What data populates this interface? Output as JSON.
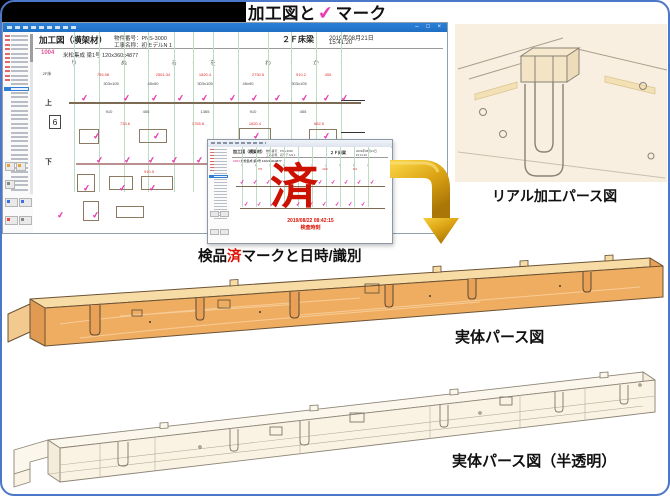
{
  "page": {
    "title": {
      "prefix": "加工図と",
      "check": "✔",
      "suffix": "マーク"
    }
  },
  "colors": {
    "check_magenta": "#e83cb0",
    "done_red": "#cc1100",
    "titlebar_blue": "#2a80d8",
    "arrow_gold": "#d29a00",
    "wood": "#efad62",
    "grid_green": "#bcdcc4",
    "frame_blue": "#4a77c8"
  },
  "main_window": {
    "titlebar_buttons": [
      "minimize",
      "maximize",
      "close"
    ],
    "header": {
      "doc_title": "加工図（横架材）",
      "property_label": "物件番号：PNS-3000",
      "project_label": "工事名称：初モデルN 1",
      "floor": "２Ｆ床梁",
      "date": "2019年08月21日",
      "time": "15:41:20",
      "part_no": "1004",
      "part_desc": "米松集成 梁1号 120x360x4877"
    },
    "sidebar": {
      "row_count": 36,
      "red_count": 11,
      "selected_index": 12
    },
    "drawing": {
      "left_label": "2F床",
      "row_label_top": "上",
      "row_label_bottom": "下",
      "sheet_no": "6",
      "grid_labels": [
        {
          "t": "り",
          "x": 41
        },
        {
          "t": "ぬ",
          "x": 91
        },
        {
          "t": "る",
          "x": 141
        },
        {
          "t": "を",
          "x": 180
        },
        {
          "t": "わ",
          "x": 235
        },
        {
          "t": "か",
          "x": 283
        }
      ],
      "grid_minor_xs": [
        66,
        115,
        160,
        205,
        258,
        308
      ],
      "grid_line_xs": [
        41,
        66,
        91,
        115,
        141,
        160,
        180,
        205,
        235,
        258,
        283,
        308
      ],
      "check_mark": "✔",
      "check_groups": [
        {
          "y": 62,
          "xs": [
            48,
            90,
            118,
            144,
            168,
            196,
            218,
            241,
            268,
            290,
            308
          ]
        },
        {
          "y": 100,
          "xs": [
            60,
            120,
            220,
            290
          ]
        },
        {
          "y": 124,
          "xs": [
            63,
            91,
            115,
            138,
            163,
            190,
            220,
            250,
            280
          ]
        },
        {
          "y": 152,
          "xs": [
            50,
            86,
            116,
            218,
            238
          ]
        },
        {
          "y": 179,
          "xs": [
            24,
            59
          ]
        }
      ],
      "dims": [
        {
          "x": 70,
          "y": 40,
          "t": "755.98",
          "c": "red"
        },
        {
          "x": 130,
          "y": 40,
          "t": "2561.34",
          "c": "red"
        },
        {
          "x": 172,
          "y": 40,
          "t": "1820.4",
          "c": "red"
        },
        {
          "x": 225,
          "y": 40,
          "t": "2730.5",
          "c": "red"
        },
        {
          "x": 268,
          "y": 40,
          "t": "910.2",
          "c": "red"
        },
        {
          "x": 295,
          "y": 40,
          "t": "455",
          "c": "red"
        },
        {
          "x": 78,
          "y": 49,
          "t": "303x105",
          "c": "blk"
        },
        {
          "x": 120,
          "y": 49,
          "t": "45x90",
          "c": "blk"
        },
        {
          "x": 172,
          "y": 49,
          "t": "303x105",
          "c": "blk"
        },
        {
          "x": 215,
          "y": 49,
          "t": "45x90",
          "c": "blk"
        },
        {
          "x": 266,
          "y": 49,
          "t": "303x105",
          "c": "blk"
        },
        {
          "x": 76,
          "y": 77,
          "t": "910",
          "c": "blk"
        },
        {
          "x": 113,
          "y": 77,
          "t": "455",
          "c": "blk"
        },
        {
          "x": 172,
          "y": 77,
          "t": "1365",
          "c": "blk"
        },
        {
          "x": 220,
          "y": 77,
          "t": "910",
          "c": "blk"
        },
        {
          "x": 270,
          "y": 77,
          "t": "455",
          "c": "blk"
        },
        {
          "x": 92,
          "y": 89,
          "t": "733.6",
          "c": "red"
        },
        {
          "x": 165,
          "y": 89,
          "t": "1765.8",
          "c": "red"
        },
        {
          "x": 222,
          "y": 89,
          "t": "1820.4",
          "c": "red"
        },
        {
          "x": 286,
          "y": 89,
          "t": "682.5",
          "c": "red"
        },
        {
          "x": 116,
          "y": 137,
          "t": "910.5",
          "c": "red"
        },
        {
          "x": 190,
          "y": 137,
          "t": "455.2",
          "c": "red"
        }
      ]
    }
  },
  "popup_window": {
    "sidebar": {
      "row_count": 24,
      "red_count": 8,
      "selected_index": 9
    },
    "header": {
      "doc_title": "加工図（横架材）",
      "property_label": "物件番号：PNS-3000",
      "project_label": "工事名称：初モデルN 1",
      "floor": "２Ｆ床梁",
      "date": "2019年08月21日",
      "time": "15:41:20",
      "part_no": "1004",
      "part_desc": "米松集成 梁1号 120x360x4877"
    },
    "drawing": {
      "grid_labels": [
        {
          "t": "り",
          "x": 12
        },
        {
          "t": "ぬ",
          "x": 26
        },
        {
          "t": "る",
          "x": 40
        },
        {
          "t": "を",
          "x": 54
        },
        {
          "t": "わ",
          "x": 68
        },
        {
          "t": "か",
          "x": 82
        },
        {
          "t": "よ",
          "x": 96
        },
        {
          "t": "た",
          "x": 110
        },
        {
          "t": "れ",
          "x": 124
        },
        {
          "t": "そ",
          "x": 138
        }
      ],
      "grid_line_xs": [
        12,
        26,
        40,
        54,
        68,
        82,
        96,
        110,
        124,
        138
      ],
      "check_mark": "✔",
      "check_groups": [
        {
          "y": 33,
          "xs": [
            10,
            23,
            36,
            49,
            62,
            75,
            88,
            101,
            114,
            127,
            140
          ]
        },
        {
          "y": 55,
          "xs": [
            14,
            27,
            40,
            53,
            66,
            79,
            92,
            105,
            118,
            131
          ]
        }
      ],
      "dims": [
        {
          "x": 30,
          "y": 21,
          "t": "755",
          "c": "red"
        },
        {
          "x": 62,
          "y": 21,
          "t": "2561",
          "c": "red"
        },
        {
          "x": 95,
          "y": 21,
          "t": "1820",
          "c": "red"
        },
        {
          "x": 125,
          "y": 21,
          "t": "910",
          "c": "red"
        }
      ]
    },
    "done_mark": "済",
    "timestamp": "2019/08/22 08:42:15",
    "timestamp_label": "検査時刻"
  },
  "captions": {
    "popup": {
      "pre": "検品",
      "done": "済",
      "post": "マークと日時/識別"
    },
    "real": "リアル加工パース図",
    "solid": "実体パース図",
    "transparent": "実体パース図（半透明）"
  }
}
